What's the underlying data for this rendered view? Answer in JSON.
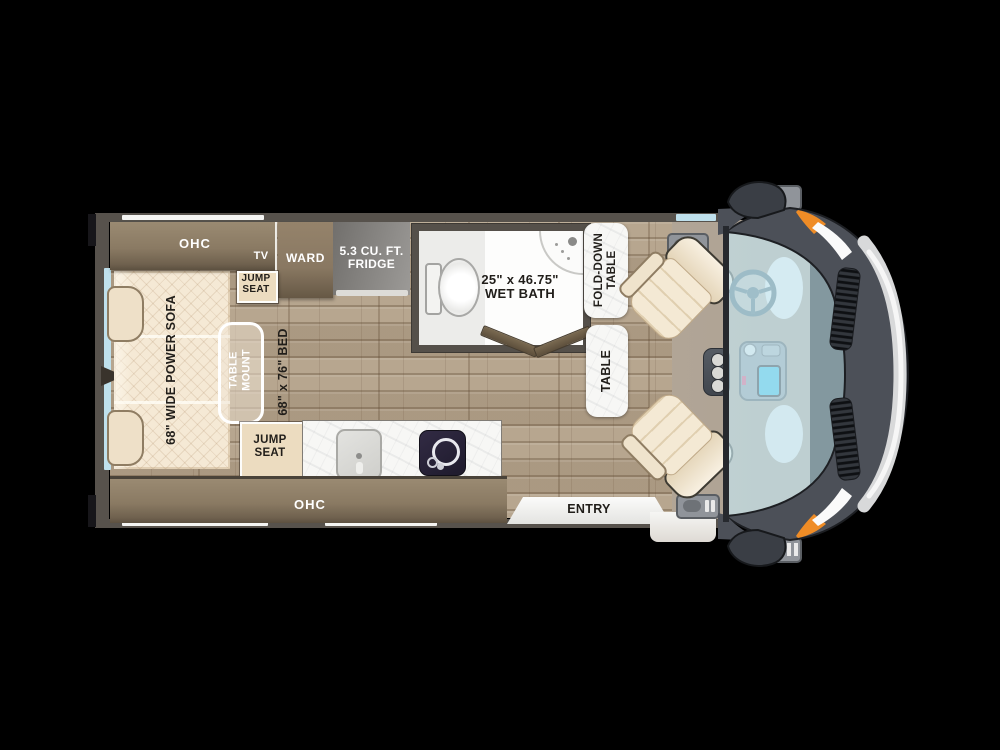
{
  "colors": {
    "background": "#000000",
    "wall": "#57524c",
    "wood_floor": "#b3a189",
    "cab_floor": "#b2a697",
    "cabinet_brown": "#8a7a63",
    "cream_upholstery": "#f2e6cf",
    "marble_white": "#f7f7f5",
    "glass_blue": "#c7e7f1",
    "van_body": "#4c5058",
    "chrome": "#d8d9da",
    "accent_orange": "#ef8c26"
  },
  "labels": {
    "ohc_top": "OHC",
    "tv": "TV",
    "ward": "WARD",
    "fridge_line1": "5.3 CU. FT.",
    "fridge_line2": "FRIDGE",
    "jump_seat_line1": "JUMP",
    "jump_seat_line2": "SEAT",
    "wet_bath_line1": "25\" x 46.75\"",
    "wet_bath_line2": "WET BATH",
    "fold_down_line1": "FOLD-DOWN",
    "fold_down_line2": "TABLE",
    "table": "TABLE",
    "table_mount_line1": "TABLE",
    "table_mount_line2": "MOUNT",
    "sofa": "68\" WIDE POWER SOFA",
    "bed": "68\" x 76\" BED",
    "ohc_bottom": "OHC",
    "entry": "ENTRY"
  }
}
